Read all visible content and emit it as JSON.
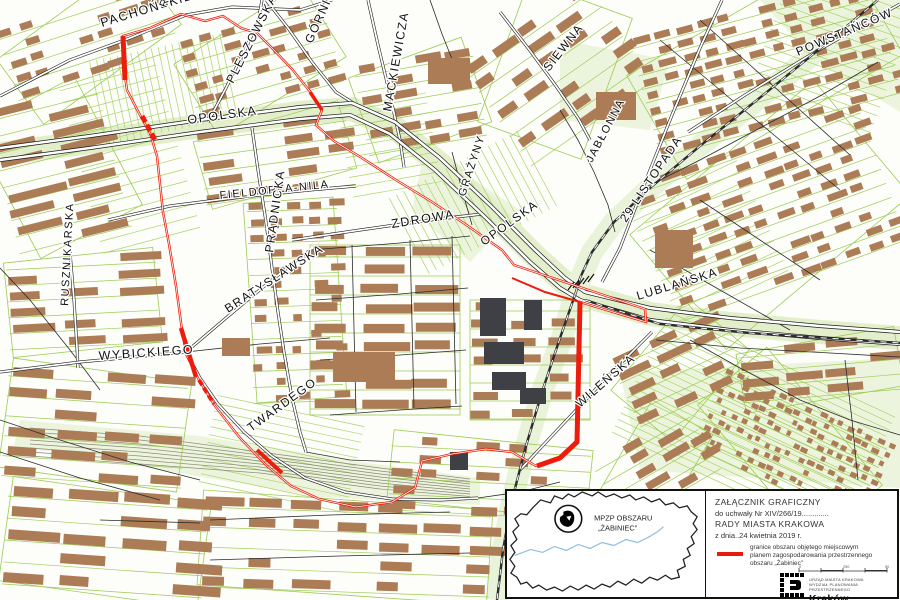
{
  "map": {
    "boundary_color": "#ee1c0c",
    "building_color": "#ab7c55",
    "green_color": "#9ccb54",
    "streets": [
      {
        "name": "PACHOŃSKIEGO",
        "x": 102,
        "y": 27,
        "rot": -17,
        "size": 12.5
      },
      {
        "name": "R",
        "x": 166,
        "y": 8,
        "rot": -70,
        "size": 11
      },
      {
        "name": "OPOLSKA",
        "x": 188,
        "y": 124,
        "rot": -8,
        "size": 12.5
      },
      {
        "name": "PLESZOWSKA",
        "x": 233,
        "y": 84,
        "rot": -63,
        "size": 12
      },
      {
        "name": "GÓRNICKIEGO",
        "x": 312,
        "y": 44,
        "rot": -66,
        "size": 12
      },
      {
        "name": "MACKIEWICZA",
        "x": 391,
        "y": 112,
        "rot": -80,
        "size": 12
      },
      {
        "name": "SIEWNA",
        "x": 549,
        "y": 72,
        "rot": -52,
        "size": 12
      },
      {
        "name": "JABŁONNA",
        "x": 592,
        "y": 163,
        "rot": -62,
        "size": 11
      },
      {
        "name": "POWSTAŃCÓW",
        "x": 798,
        "y": 56,
        "rot": -23,
        "size": 12
      },
      {
        "name": "FIELDORFA-NILA",
        "x": 220,
        "y": 199,
        "rot": -6,
        "size": 11
      },
      {
        "name": "ZDROWA",
        "x": 392,
        "y": 228,
        "rot": -9,
        "size": 12.5
      },
      {
        "name": "GRAŻYNY",
        "x": 465,
        "y": 197,
        "rot": -72,
        "size": 11
      },
      {
        "name": "OPOLSKA",
        "x": 484,
        "y": 246,
        "rot": -36,
        "size": 12
      },
      {
        "name": "PRĄDNICKA",
        "x": 273,
        "y": 253,
        "rot": -82,
        "size": 12
      },
      {
        "name": "BRATYSŁAWSKA",
        "x": 228,
        "y": 313,
        "rot": -33,
        "size": 12
      },
      {
        "name": "RUSZNIKARSKA",
        "x": 68,
        "y": 306,
        "rot": -87,
        "size": 11
      },
      {
        "name": "WYBICKIEGO",
        "x": 99,
        "y": 360,
        "rot": -4,
        "size": 12.5
      },
      {
        "name": "TWARDEGO",
        "x": 251,
        "y": 432,
        "rot": -36,
        "size": 12
      },
      {
        "name": "29 LISTOPADA",
        "x": 626,
        "y": 223,
        "rot": -56,
        "size": 12
      },
      {
        "name": "LUBLAŃSKA",
        "x": 638,
        "y": 300,
        "rot": -17,
        "size": 12
      },
      {
        "name": "WILEŃSKA",
        "x": 580,
        "y": 408,
        "rot": -41,
        "size": 12
      }
    ]
  },
  "legend": {
    "title_line1": "ZAŁĄCZNIK GRAFICZNY",
    "title_line2": "do uchwały Nr XIV/266/19.............",
    "title_line3": "RADY MIASTA KRAKOWA",
    "title_line4": "z dnia..24 kwietnia 2019 r.",
    "item_line1": "granice obszaru objętego miejscowym",
    "item_line2": "planem zagospodarowania przestrzennego",
    "item_line3": "obszaru „Żabiniec”",
    "inset_label_line1": "MPZP OBSZARU",
    "inset_label_line2": "„ŻABINIEC”",
    "scale_labels": [
      "0",
      "250",
      "500"
    ],
    "logo_org_line1": "URZĄD MIASTA KRAKOWA",
    "logo_org_line2": "WYDZIAŁ PLANOWANIA PRZESTRZENNEGO",
    "logo_city": "Kraków"
  }
}
